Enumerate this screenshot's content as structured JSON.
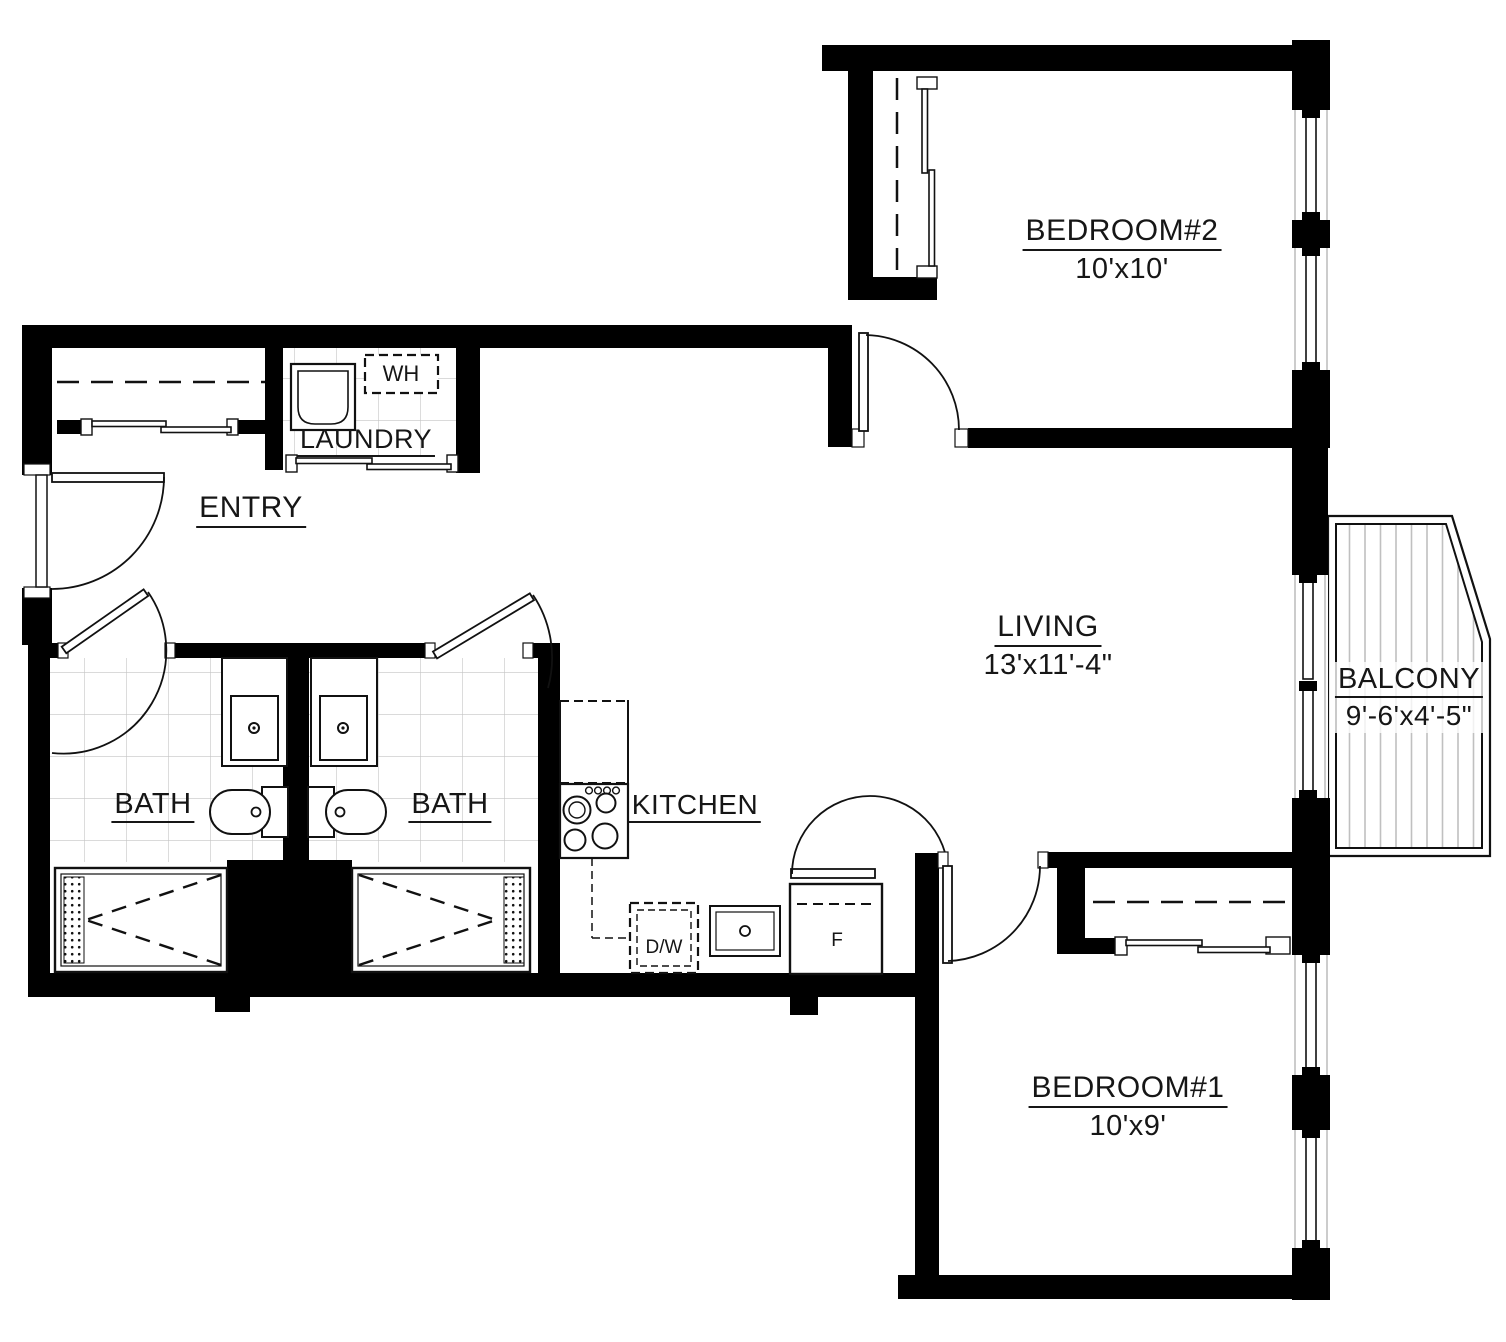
{
  "plan": {
    "title": "Two bedroom two bath apartment floor plan",
    "rooms": {
      "bedroom2": {
        "label": "BEDROOM#2",
        "dims": "10'x10'"
      },
      "living": {
        "label": "LIVING",
        "dims": "13'x11'-4\""
      },
      "balcony": {
        "label": "BALCONY",
        "dims": "9'-6'x4'-5\""
      },
      "entry": {
        "label": "ENTRY"
      },
      "laundry": {
        "label": "LAUNDRY"
      },
      "bath_left": {
        "label": "BATH"
      },
      "bath_right": {
        "label": "BATH"
      },
      "kitchen": {
        "label": "KITCHEN"
      },
      "bedroom1": {
        "label": "BEDROOM#1",
        "dims": "10'x9'"
      }
    },
    "appliances": {
      "water_heater": "WH",
      "dishwasher": "D/W",
      "refrigerator": "F"
    },
    "colors": {
      "wall": "#000000",
      "text": "#161616",
      "tile_line": "#c4c4c4",
      "deck_line": "#c0c0c0"
    }
  }
}
